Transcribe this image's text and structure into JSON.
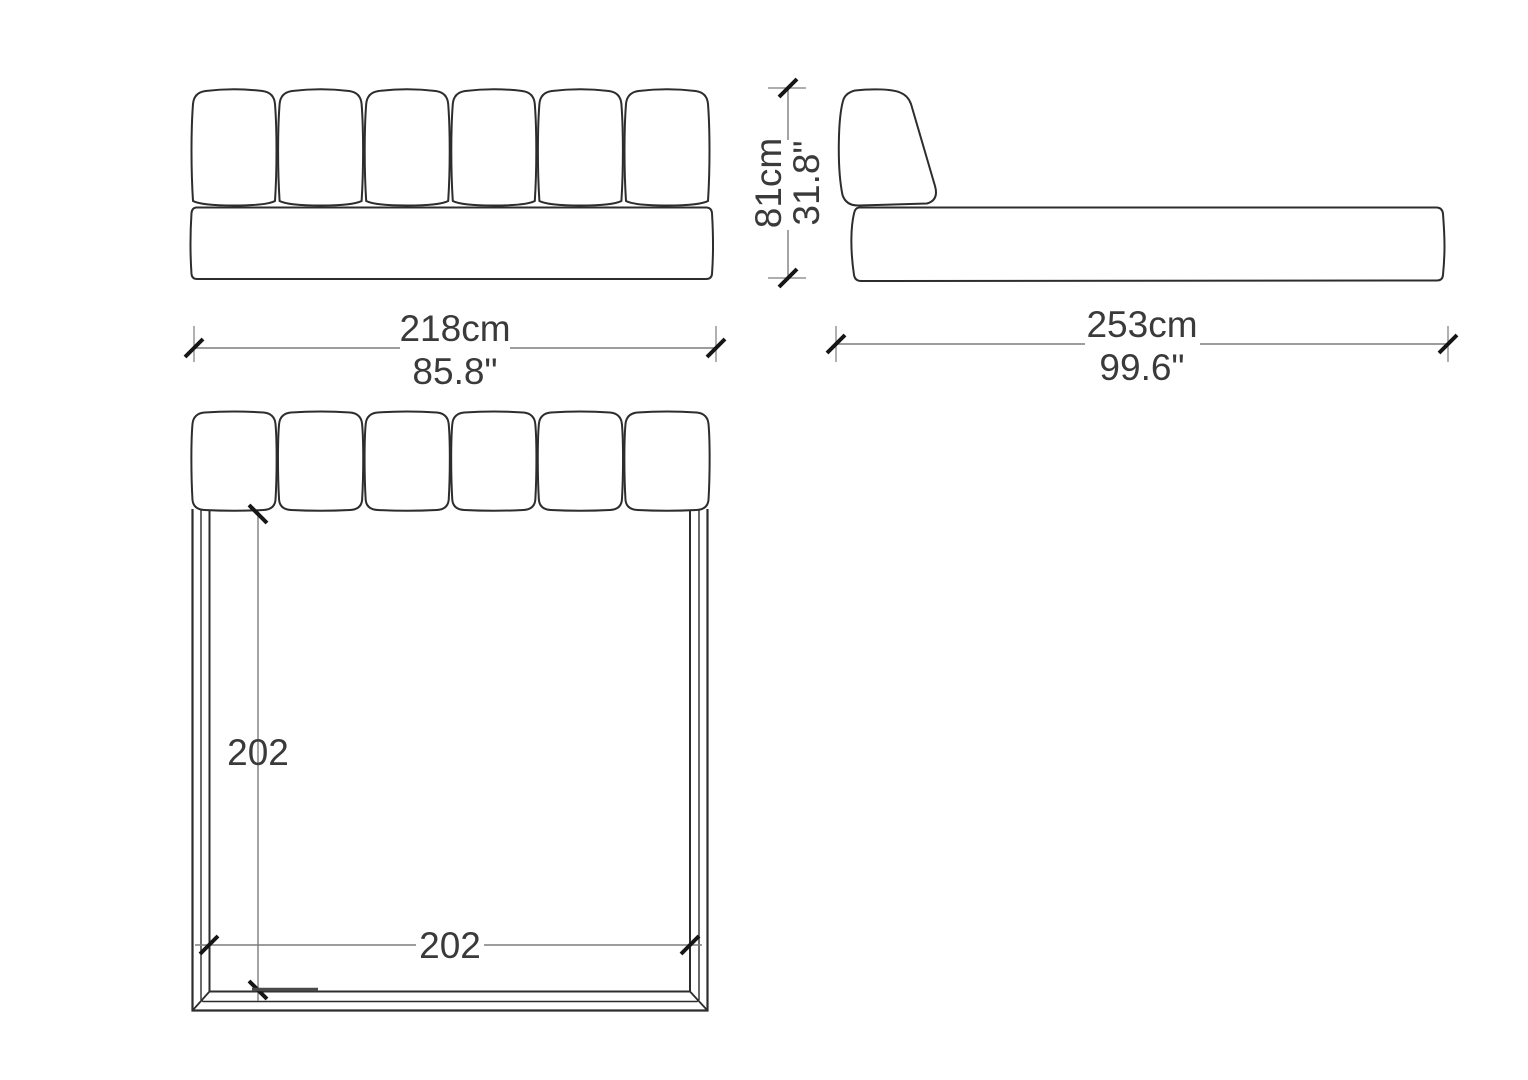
{
  "headboard_cushion_count": 6,
  "views": {
    "front": {
      "width_label_cm": "218cm",
      "width_label_in": "85.8\""
    },
    "side": {
      "height_label_cm": "81cm",
      "height_label_in": "31.8\"",
      "length_label_cm": "253cm",
      "length_label_in": "99.6\""
    },
    "top": {
      "depth_label": "202",
      "width_label": "202"
    }
  },
  "colors": {
    "bg": "#ffffff",
    "outline": "#2d2d2d",
    "dim": "#7d7d7d",
    "tick": "#161616",
    "text": "#3a3a3a"
  }
}
